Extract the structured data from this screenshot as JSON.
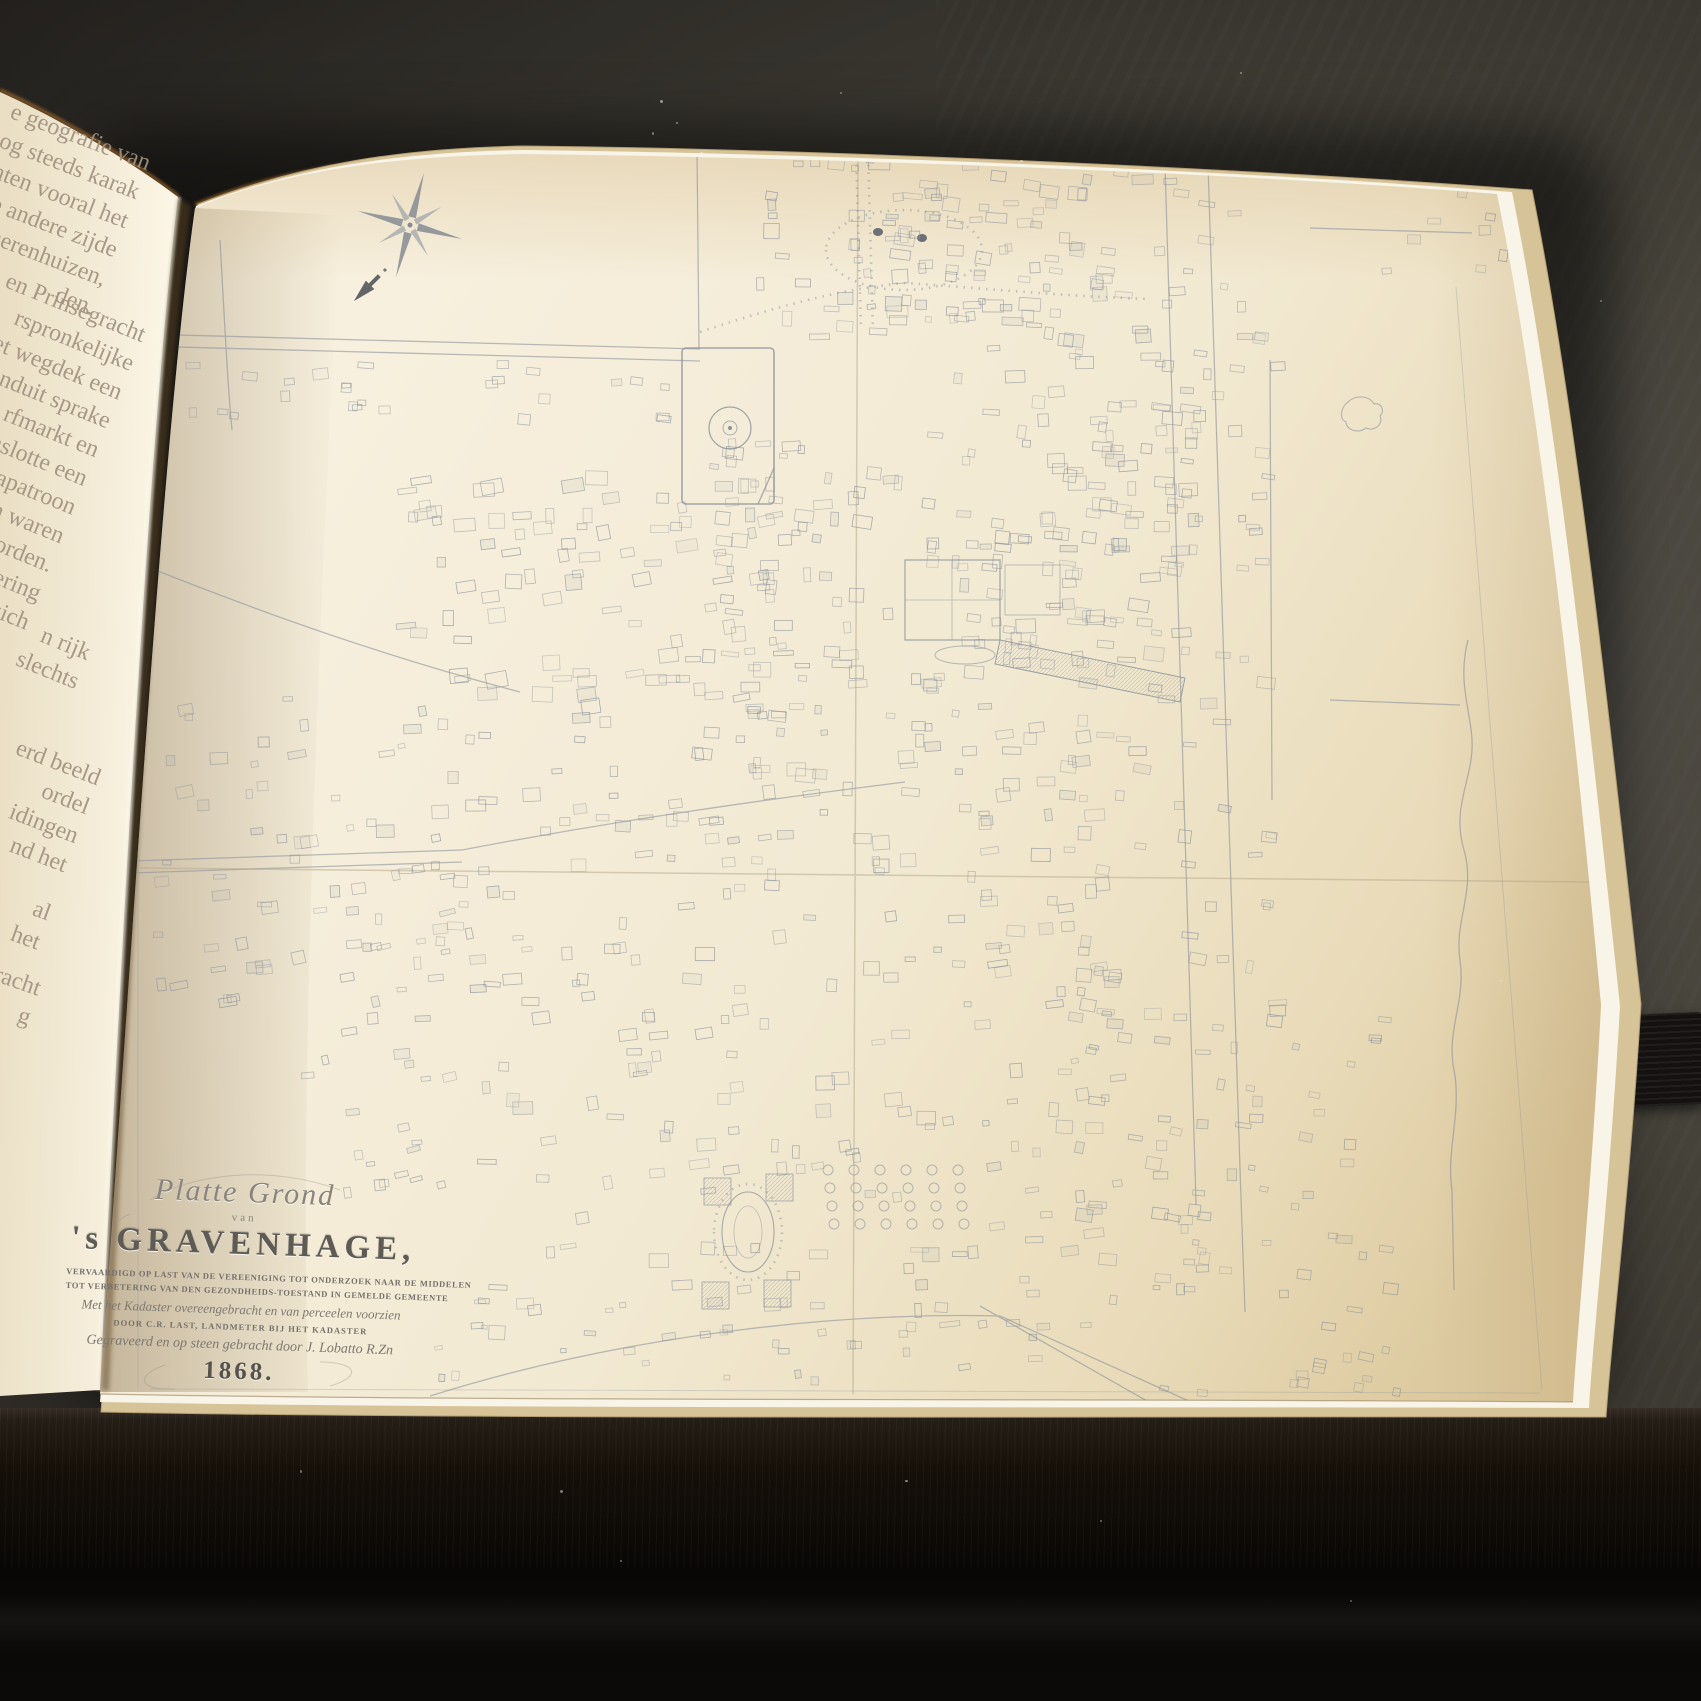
{
  "book": {
    "left_page": {
      "fragments": [
        {
          "lines": [
            "e geografie van",
            "n nog steeds karak",
            "grachten vooral het",
            "n de andere zijde",
            "n herenhuizen,",
            "den."
          ]
        },
        {
          "lines": [
            "en Prinsegracht",
            "rspronkelijke",
            "het wegdek een",
            "onduit sprake",
            "rfmarkt en",
            "nslotte een",
            "apatroon",
            "n waren",
            "geworden.",
            "e schakering",
            "die zich"
          ]
        },
        {
          "lines": [
            "n rijk",
            "slechts"
          ]
        },
        {
          "lines": [
            "erd beeld",
            "ordel",
            "idingen",
            "nd het"
          ]
        },
        {
          "lines": [
            "al",
            "het"
          ]
        },
        {
          "lines": [
            "racht",
            "g"
          ]
        }
      ]
    },
    "map_page": {
      "cartouche": {
        "script_title": "Platte Grond",
        "van": "van",
        "city_title": "'s GRAVENHAGE,",
        "subtitle_1": "VERVAARDIGD OP LAST VAN DE VEREENIGING TOT ONDERZOEK NAAR DE MIDDELEN",
        "subtitle_2": "TOT VERBETERING VAN DEN GEZONDHEIDS-TOESTAND IN GEMELDE GEMEENTE",
        "subtitle_3": "Met het Kadaster overeengebracht en van perceelen voorzien",
        "subtitle_4": "DOOR C.R. LAST, LANDMETER BIJ HET KADASTER",
        "subtitle_5": "Gegraveerd en op steen gebracht door J. Lobatto R.Zn",
        "year": "1868."
      },
      "icons": {
        "compass": "compass-rose-icon",
        "north_arrow": "north-arrow-icon"
      }
    }
  },
  "colors": {
    "page_cream": "#f2e9d4",
    "map_ink": "#8d939b",
    "table_wood": "#0b0908",
    "background_gray": "#413e39",
    "elastic_band": "#141110",
    "rim_glow": "#b5762b"
  }
}
